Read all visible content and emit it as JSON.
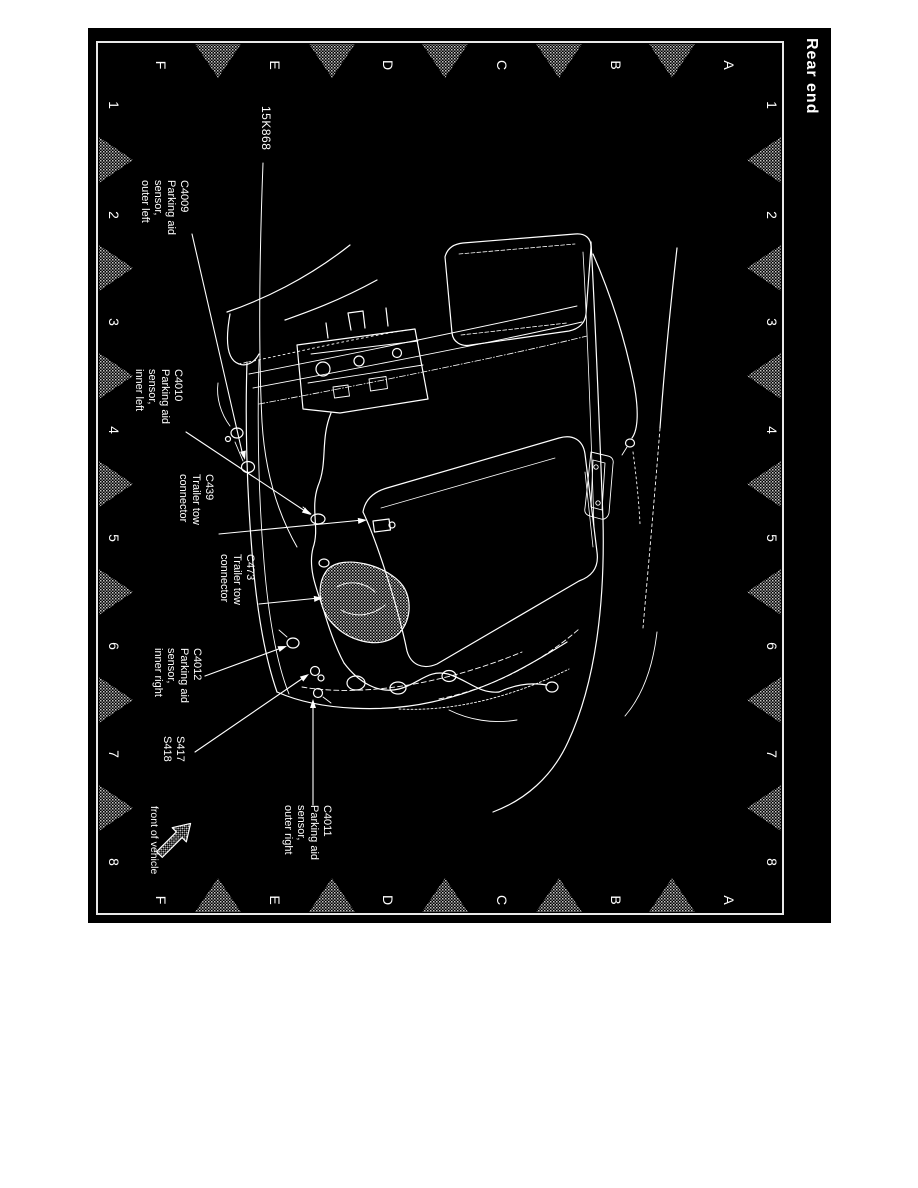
{
  "page": {
    "title": "Rear end"
  },
  "grid": {
    "letters": [
      "F",
      "E",
      "D",
      "C",
      "B",
      "A"
    ],
    "numbers": [
      "1",
      "2",
      "3",
      "4",
      "5",
      "6",
      "7",
      "8"
    ]
  },
  "callouts": {
    "part_number": "15K868",
    "c4009": "C4009\nParking aid\nsensor,\nouter left",
    "c4010": "C4010\nParking aid\nsensor,\ninner left",
    "c439": "C439\nTrailer tow\nconnector",
    "c473": "C473\nTrailer tow\nconnector",
    "c4012": "C4012\nParking aid\nsensor,\ninner right",
    "s417_s418": "S417\nS418",
    "c4011": "C4011\nParking aid\nsensor,\nouter right",
    "front_note": "front of vehicle"
  },
  "colors": {
    "page_bg": "#ffffff",
    "canvas_bg": "#000000",
    "line": "#ffffff",
    "marker_gray": "#9a9a9a"
  }
}
